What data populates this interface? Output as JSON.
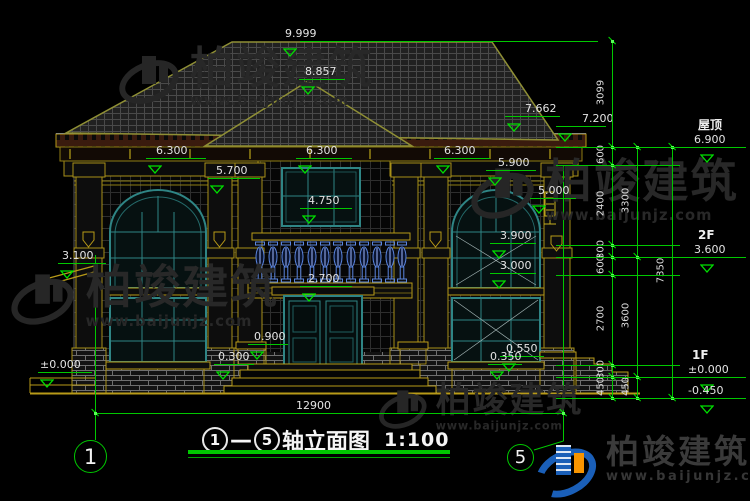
{
  "watermark": {
    "brand": "柏竣建筑",
    "site": "www.baijunjz.com"
  },
  "footer": {
    "brand": "柏竣建筑",
    "site": "www.baijunjz.com"
  },
  "title": {
    "axis_from": "1",
    "dash": "—",
    "axis_to": "5",
    "name": "轴立面图",
    "scale": "1:100"
  },
  "bottom_dim": {
    "label": "12900"
  },
  "axes": [
    {
      "n": "1",
      "cx": 91,
      "cy": 457,
      "r": 17
    },
    {
      "n": "5",
      "cx": 521,
      "cy": 458,
      "r": 14
    }
  ],
  "markers": [
    {
      "t": "9.999",
      "x": 281,
      "y": 41,
      "w": 0,
      "ldx": 4
    },
    {
      "t": "8.857",
      "x": 299,
      "y": 79,
      "w": 46,
      "ldx": 6
    },
    {
      "t": "7.662",
      "x": 505,
      "y": 116,
      "w": 55,
      "ldx": 20
    },
    {
      "t": "7.200",
      "x": 556,
      "y": 126,
      "w": 50,
      "ldx": 26
    },
    {
      "t": "6.300",
      "x": 146,
      "y": 158,
      "w": 60,
      "ldx": 10
    },
    {
      "t": "6.300",
      "x": 296,
      "y": 158,
      "w": 56,
      "ldx": 10
    },
    {
      "t": "6.300",
      "x": 434,
      "y": 158,
      "w": 56,
      "ldx": 10
    },
    {
      "t": "5.900",
      "x": 486,
      "y": 170,
      "w": 50,
      "ldx": 12
    },
    {
      "t": "5.700",
      "x": 208,
      "y": 178,
      "w": 52,
      "ldx": 8
    },
    {
      "t": "5.000",
      "x": 530,
      "y": 198,
      "w": 46,
      "ldx": 8
    },
    {
      "t": "4.750",
      "x": 300,
      "y": 208,
      "w": 52,
      "ldx": 8
    },
    {
      "t": "3.900",
      "x": 490,
      "y": 243,
      "w": 46,
      "ldx": 10
    },
    {
      "t": "3.100",
      "x": 58,
      "y": 263,
      "w": 48,
      "ldx": 4
    },
    {
      "t": "3.000",
      "x": 490,
      "y": 273,
      "w": 46,
      "ldx": 10
    },
    {
      "t": "2.700",
      "x": 300,
      "y": 286,
      "w": 52,
      "ldx": 8
    },
    {
      "t": "0.900",
      "x": 248,
      "y": 344,
      "w": 40,
      "ldx": 6
    },
    {
      "t": "0.300",
      "x": 214,
      "y": 364,
      "w": 40,
      "ldx": 4
    },
    {
      "t": "0.550",
      "x": 500,
      "y": 356,
      "w": 44,
      "ldx": 6
    },
    {
      "t": "0.350",
      "x": 488,
      "y": 364,
      "w": 34,
      "ldx": 2
    },
    {
      "t": "±0.000",
      "x": 38,
      "y": 372,
      "w": 54,
      "ldx": 2
    },
    {
      "t": "6.900",
      "tag": "屋顶",
      "x": 656,
      "y": 147,
      "w": 90,
      "ldx": 38,
      "tx": 44
    },
    {
      "t": "3.600",
      "tag": "2F",
      "x": 656,
      "y": 257,
      "w": 90,
      "ldx": 38,
      "tx": 44
    },
    {
      "t": "±0.000",
      "tag": "1F",
      "x": 656,
      "y": 377,
      "w": 90,
      "ldx": 32,
      "tx": 44
    },
    {
      "t": "-0.450",
      "tag": "",
      "x": 656,
      "y": 398,
      "w": 90,
      "ldx": 32,
      "tx": 44
    }
  ],
  "chains": [
    {
      "x": 612,
      "ys": [
        41,
        147,
        165,
        245,
        257,
        275,
        365,
        377,
        398
      ],
      "labels": [
        {
          "t": "3099",
          "y": 94
        },
        {
          "t": "600",
          "y": 156
        },
        {
          "t": "2400",
          "y": 205
        },
        {
          "t": "300",
          "y": 251
        },
        {
          "t": "600",
          "y": 266
        },
        {
          "t": "2700",
          "y": 320
        },
        {
          "t": "300",
          "y": 371
        },
        {
          "t": "450",
          "y": 388
        }
      ]
    },
    {
      "x": 637,
      "ys": [
        147,
        257,
        377,
        398
      ],
      "labels": [
        {
          "t": "3300",
          "y": 202
        },
        {
          "t": "3600",
          "y": 317
        },
        {
          "t": "450",
          "y": 388
        }
      ]
    },
    {
      "x": 672,
      "ys": [
        147,
        398
      ],
      "labels": [
        {
          "t": "7350",
          "y": 272
        }
      ]
    }
  ],
  "ext_lines": {
    "x1": 556,
    "x2": 680,
    "top_line_y": 41
  },
  "dim_line": {
    "x1": 95,
    "x2": 563,
    "y": 413,
    "label_x": 296,
    "label_y": 400
  },
  "watermarks_pos": [
    {
      "x": 118,
      "y": 48,
      "s": 1.0
    },
    {
      "x": 10,
      "y": 266,
      "s": 1.05
    },
    {
      "x": 470,
      "y": 160,
      "s": 1.05
    },
    {
      "x": 378,
      "y": 384,
      "s": 0.8
    }
  ],
  "colors": {
    "dim_green": "#00c800",
    "cad_yellow": "#b89a18",
    "window_teal": "#2f8585",
    "baluster_blue": "#5b86e0",
    "logo_blue": "#1a5fb8",
    "logo_orange": "#f79400"
  }
}
